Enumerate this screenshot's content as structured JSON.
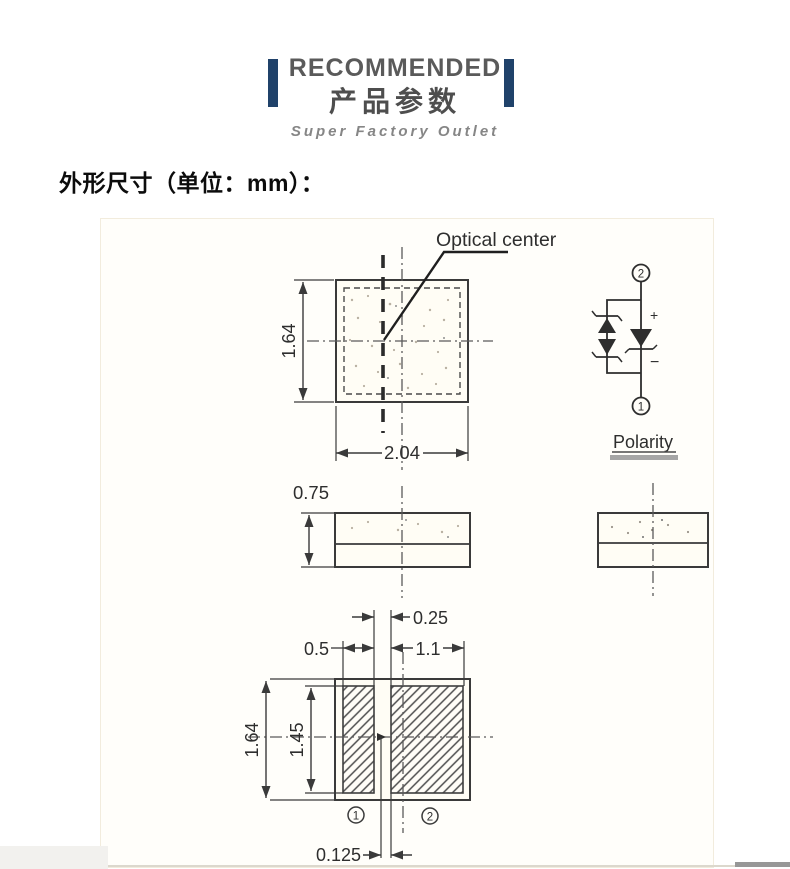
{
  "header": {
    "accent_color": "#20426a",
    "title_en": "RECOMMENDED",
    "title_zh": "产品参数",
    "subtitle": "Super Factory Outlet"
  },
  "section_heading": "外形尺寸（单位：mm）：",
  "diagram": {
    "labels": {
      "optical_center": "Optical center",
      "polarity": "Polarity",
      "plus": "+",
      "minus": "−",
      "terminal_top": "2",
      "terminal_bottom": "1",
      "pad_left": "1",
      "pad_right": "2"
    },
    "dimensions_mm": {
      "top_view_width": "2.04",
      "top_view_height": "1.64",
      "thickness": "0.75",
      "pad_gap": "0.25",
      "pad_left_width": "0.5",
      "pad_right_width": "1.1",
      "bottom_view_height": "1.64",
      "pad_height": "1.45",
      "center_to_pad_offset": "0.125"
    },
    "line_color": "#3a3a3a"
  }
}
